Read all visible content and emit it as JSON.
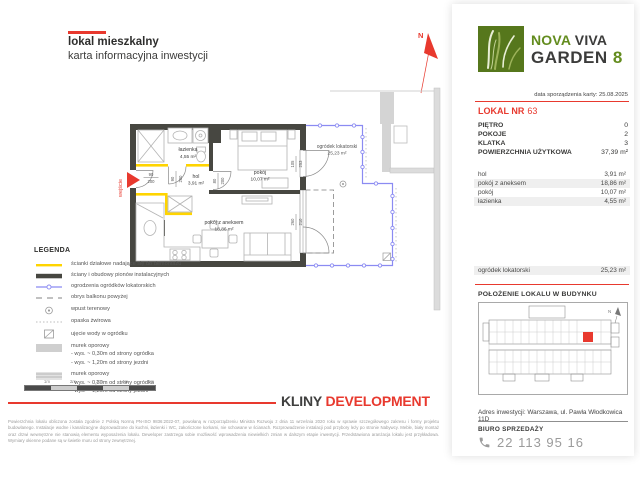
{
  "header": {
    "tag": "lokal mieszkalny",
    "subtitle": "karta informacyjna inwestycji"
  },
  "brand": {
    "nova": "NOVA",
    "viva": "VIVA",
    "garden": "GARDEN",
    "number": "8"
  },
  "unit": {
    "date_line": "data sporządzenia karty: 25.08.2025",
    "lokal_label": "LOKAL NR",
    "lokal_number": "63",
    "attributes": [
      {
        "label": "PIĘTRO",
        "value": "0"
      },
      {
        "label": "POKOJE",
        "value": "2"
      },
      {
        "label": "KLATKA",
        "value": "3"
      },
      {
        "label": "POWIERZCHNIA UŻYTKOWA",
        "value": "37,39 m²"
      }
    ],
    "rooms": [
      {
        "name": "hol",
        "area": "3,91 m²"
      },
      {
        "name": "pokój z aneksem",
        "area": "18,86 m²"
      },
      {
        "name": "pokój",
        "area": "10,07 m²"
      },
      {
        "name": "łazienka",
        "area": "4,55 m²"
      }
    ],
    "extras": [
      {
        "name": "ogródek lokatorski",
        "area": "25,23 m²"
      }
    ]
  },
  "plan": {
    "north_label": "N",
    "entrance_label": "wejście",
    "rooms": {
      "bathroom": {
        "name": "łazienka",
        "area": "4,55 m²"
      },
      "hall": {
        "name": "hol",
        "area": "3,91 m²"
      },
      "room": {
        "name": "pokój",
        "area": "10,07 m²"
      },
      "living": {
        "name": "pokój z aneksem",
        "area": "18,86 m²"
      },
      "garden": {
        "name": "ogródek lokatorski",
        "area": "25,23 m²"
      }
    },
    "dims": {
      "entrance": [
        "90",
        "200"
      ],
      "bath_door": [
        "90",
        "200"
      ],
      "room_door": [
        "80",
        "200"
      ],
      "garden_door": [
        "105",
        "253"
      ],
      "living_window": [
        "260",
        "210"
      ]
    }
  },
  "legend": {
    "title": "LEGENDA",
    "items": [
      {
        "symbol": "yellow-partition-line",
        "label": "ścianki działowe nadające się do demontażu"
      },
      {
        "symbol": "dark-wall-bar",
        "label": "ściany i obudowy pionów instalacyjnych"
      },
      {
        "symbol": "garden-fence-line",
        "label": "ogrodzenia ogródków lokatorskich"
      },
      {
        "symbol": "dashed-line",
        "label": "obrys balkonu powyżej"
      },
      {
        "symbol": "drain-symbol",
        "label": "wpust terenowy"
      },
      {
        "symbol": "gravel-line",
        "label": "opaska żwirowa"
      },
      {
        "symbol": "water-intake-symbol",
        "label": "ujęcie wody w ogródku"
      },
      {
        "symbol": "retaining-wall-solid",
        "label": "murek oporowy",
        "sublines": [
          "- wys. ~ 0,30m od strony ogródka",
          "- wys. ~ 1,20m od strony jezdni"
        ]
      },
      {
        "symbol": "retaining-wall-striped",
        "label": "murek oporowy",
        "sublines": [
          "- wys. ~ 0,30m od strony ogródka",
          "- wys. ~ 1,20m od strony jezdni"
        ]
      }
    ]
  },
  "scalebar": {
    "labels": [
      "1m",
      "2m",
      "3m",
      "4m",
      "5m"
    ]
  },
  "location": {
    "heading": "POŁOŻENIE LOKALU W BUDYNKU",
    "north_label": "N"
  },
  "contact": {
    "address": "Adres inwestycji: Warszawa, ul. Pawła Włodkowica 11D",
    "sales_label": "BIURO SPRZEDAŻY",
    "phone": "22 113 95 16"
  },
  "developer": {
    "name": "KLINY",
    "suffix": "DEVELOPMENT"
  },
  "disclaimer": {
    "text": "Powierzchnia lokalu obliczona została zgodnie z Polską Normą PN-ISO 9836:2022-07, powołaną w rozporządzeniu Ministra Rozwoju z dnia 11 września 2020 roku w sprawie szczegółowego zakresu i formy projektu budowlanego. Instalacje wodne i kanalizacyjne doprowadzone do kuchni, łazienki i WC, zakończone korkami, nie schowane w ścianach. Rozprowadzenie instalacji pod przybory leży po stronie Nabywcy. Meble, biały montaż oraz drzwi wewnętrzne nie stanowią elementu wyposażenia lokalu. Deweloper zastrzega sobie możliwość wprowadzenia niewielkich zmian w dalszym etapie inwestycji. Przedstawiona aranżacja lokalu jest przykładowa. Wymiary okienne podane są w świetle muru od strony zewnętrznej."
  },
  "colors": {
    "accent_red": "#e8392e",
    "brand_green": "#638c1e",
    "wall_dark": "#474741",
    "partition_yellow": "#ffd400",
    "fence_blue": "#8b8bf2"
  }
}
